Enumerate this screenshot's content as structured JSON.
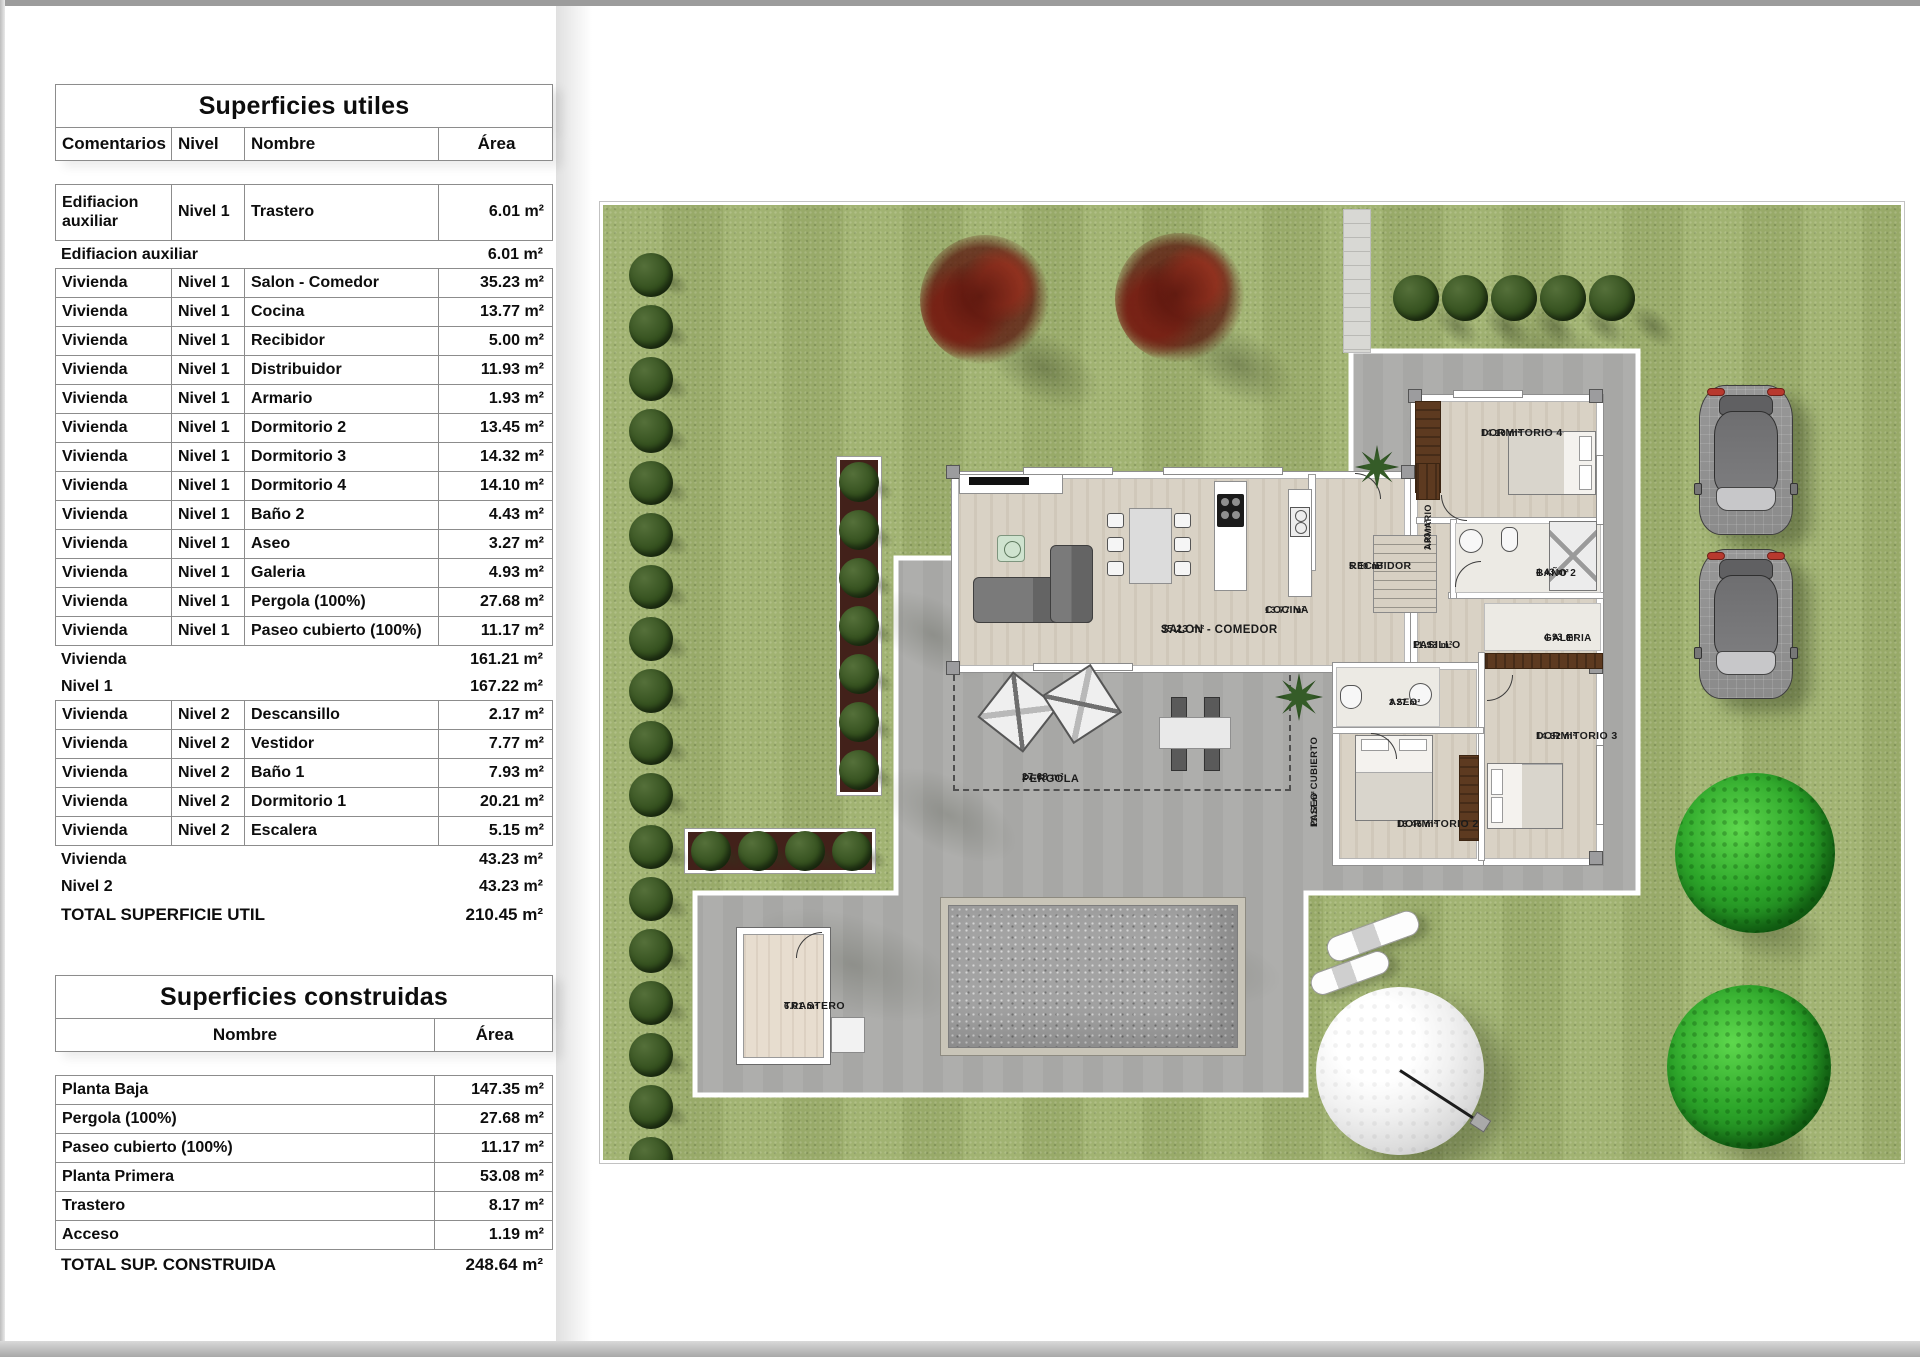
{
  "tables": {
    "utiles": {
      "title": "Superficies utiles",
      "columns": [
        "Comentarios",
        "Nivel",
        "Nombre",
        "Área"
      ],
      "rows": [
        {
          "kind": "data",
          "tall": true,
          "comentarios": "Edifiacion auxiliar",
          "nivel": "Nivel 1",
          "nombre": "Trastero",
          "area": "6.01 m²"
        },
        {
          "kind": "summary",
          "label": "Edifiacion auxiliar",
          "area": "6.01 m²"
        },
        {
          "kind": "data",
          "comentarios": "Vivienda",
          "nivel": "Nivel 1",
          "nombre": "Salon - Comedor",
          "area": "35.23 m²"
        },
        {
          "kind": "data",
          "comentarios": "Vivienda",
          "nivel": "Nivel 1",
          "nombre": "Cocina",
          "area": "13.77 m²"
        },
        {
          "kind": "data",
          "comentarios": "Vivienda",
          "nivel": "Nivel 1",
          "nombre": "Recibidor",
          "area": "5.00 m²"
        },
        {
          "kind": "data",
          "comentarios": "Vivienda",
          "nivel": "Nivel 1",
          "nombre": "Distribuidor",
          "area": "11.93 m²"
        },
        {
          "kind": "data",
          "comentarios": "Vivienda",
          "nivel": "Nivel 1",
          "nombre": "Armario",
          "area": "1.93 m²"
        },
        {
          "kind": "data",
          "comentarios": "Vivienda",
          "nivel": "Nivel 1",
          "nombre": "Dormitorio 2",
          "area": "13.45 m²"
        },
        {
          "kind": "data",
          "comentarios": "Vivienda",
          "nivel": "Nivel 1",
          "nombre": "Dormitorio 3",
          "area": "14.32 m²"
        },
        {
          "kind": "data",
          "comentarios": "Vivienda",
          "nivel": "Nivel 1",
          "nombre": "Dormitorio 4",
          "area": "14.10 m²"
        },
        {
          "kind": "data",
          "comentarios": "Vivienda",
          "nivel": "Nivel 1",
          "nombre": "Baño 2",
          "area": "4.43 m²"
        },
        {
          "kind": "data",
          "comentarios": "Vivienda",
          "nivel": "Nivel 1",
          "nombre": "Aseo",
          "area": "3.27 m²"
        },
        {
          "kind": "data",
          "comentarios": "Vivienda",
          "nivel": "Nivel 1",
          "nombre": "Galeria",
          "area": "4.93 m²"
        },
        {
          "kind": "data",
          "comentarios": "Vivienda",
          "nivel": "Nivel 1",
          "nombre": "Pergola (100%)",
          "area": "27.68 m²"
        },
        {
          "kind": "data",
          "comentarios": "Vivienda",
          "nivel": "Nivel 1",
          "nombre": "Paseo cubierto (100%)",
          "area": "11.17 m²"
        },
        {
          "kind": "summary",
          "label": "Vivienda",
          "area": "161.21 m²"
        },
        {
          "kind": "summary",
          "label": "Nivel 1",
          "area": "167.22 m²"
        },
        {
          "kind": "data",
          "comentarios": "Vivienda",
          "nivel": "Nivel 2",
          "nombre": "Descansillo",
          "area": "2.17 m²"
        },
        {
          "kind": "data",
          "comentarios": "Vivienda",
          "nivel": "Nivel 2",
          "nombre": "Vestidor",
          "area": "7.77 m²"
        },
        {
          "kind": "data",
          "comentarios": "Vivienda",
          "nivel": "Nivel 2",
          "nombre": "Baño 1",
          "area": "7.93 m²"
        },
        {
          "kind": "data",
          "comentarios": "Vivienda",
          "nivel": "Nivel 2",
          "nombre": "Dormitorio 1",
          "area": "20.21 m²"
        },
        {
          "kind": "data",
          "comentarios": "Vivienda",
          "nivel": "Nivel 2",
          "nombre": "Escalera",
          "area": "5.15 m²"
        },
        {
          "kind": "summary",
          "label": "Vivienda",
          "area": "43.23 m²"
        },
        {
          "kind": "summary",
          "label": "Nivel 2",
          "area": "43.23 m²"
        },
        {
          "kind": "total",
          "label": "TOTAL SUPERFICIE UTIL",
          "area": "210.45 m²"
        }
      ]
    },
    "construidas": {
      "title": "Superficies construidas",
      "columns": [
        "Nombre",
        "Área"
      ],
      "rows": [
        {
          "kind": "data",
          "nombre": "Planta Baja",
          "area": "147.35 m²"
        },
        {
          "kind": "data",
          "nombre": "Pergola (100%)",
          "area": "27.68 m²"
        },
        {
          "kind": "data",
          "nombre": "Paseo cubierto (100%)",
          "area": "11.17 m²"
        },
        {
          "kind": "data",
          "nombre": "Planta Primera",
          "area": "53.08 m²"
        },
        {
          "kind": "data",
          "nombre": "Trastero",
          "area": "8.17 m²"
        },
        {
          "kind": "data",
          "nombre": "Acceso",
          "area": "1.19 m²"
        },
        {
          "kind": "total",
          "label": "TOTAL SUP. CONSTRUIDA",
          "area": "248.64 m²"
        }
      ]
    }
  },
  "plan": {
    "rooms": [
      {
        "id": "salon",
        "label": "SALON - COMEDOR",
        "area": "35.23 m²",
        "x": 558,
        "y": 418,
        "fs": 11.5,
        "vertical": false
      },
      {
        "id": "cocina",
        "label": "COCINA",
        "area": "13.77 m²",
        "x": 662,
        "y": 399,
        "fs": 10.5,
        "vertical": false
      },
      {
        "id": "recibidor",
        "label": "RECIBIDOR",
        "area": "5.00 m²",
        "x": 746,
        "y": 355,
        "fs": 10.5,
        "vertical": false
      },
      {
        "id": "pasillo",
        "label": "PASILLO",
        "area": "11.93 m²",
        "x": 810,
        "y": 434,
        "fs": 10.5,
        "vertical": false
      },
      {
        "id": "armario",
        "label": "ARMARIO",
        "area": "1.93 m²",
        "x": 820,
        "y": 345,
        "fs": 9,
        "vertical": true
      },
      {
        "id": "dormitorio4",
        "label": "DORMITORIO 4",
        "area": "14.10 m²",
        "x": 878,
        "y": 222,
        "fs": 10.5,
        "vertical": false
      },
      {
        "id": "bano2",
        "label": "BAÑO 2",
        "area": "4.43 m²",
        "x": 933,
        "y": 362,
        "fs": 10,
        "vertical": false
      },
      {
        "id": "galeria",
        "label": "GALERIA",
        "area": "4.93 m²",
        "x": 941,
        "y": 427,
        "fs": 10,
        "vertical": false
      },
      {
        "id": "dormitorio3",
        "label": "DORMITORIO 3",
        "area": "14.32 m²",
        "x": 933,
        "y": 525,
        "fs": 10.5,
        "vertical": false
      },
      {
        "id": "aseo",
        "label": "ASEO",
        "area": "3.27 m²",
        "x": 786,
        "y": 492,
        "fs": 9.5,
        "vertical": false
      },
      {
        "id": "dormitorio2",
        "label": "DORMITORIO 2",
        "area": "13.45 m²",
        "x": 794,
        "y": 613,
        "fs": 10.5,
        "vertical": false
      },
      {
        "id": "paseo-cubierto",
        "label": "PASEO CUBIERTO",
        "area": "11.17 m²",
        "x": 706,
        "y": 622,
        "fs": 9.5,
        "vertical": true
      },
      {
        "id": "pergola",
        "label": "PERGOLA",
        "area": "27.68 m²",
        "x": 419,
        "y": 567,
        "fs": 11,
        "vertical": false
      },
      {
        "id": "trastero",
        "label": "TRASTERO",
        "area": "6.01 m²",
        "x": 181,
        "y": 795,
        "fs": 10.5,
        "vertical": false
      }
    ],
    "colors": {
      "grass": "#9eb06d",
      "terrace": "#aeaeac",
      "bush": "#2f4a20",
      "soil": "#42211a",
      "tree_red": "#6b1f14",
      "tree_green": "#2da62a",
      "floor_wood": "#d9d2c5",
      "wall": "#ffffff",
      "pool_gravel": "#a3a3a3",
      "car_tail": "#b8392e"
    }
  }
}
